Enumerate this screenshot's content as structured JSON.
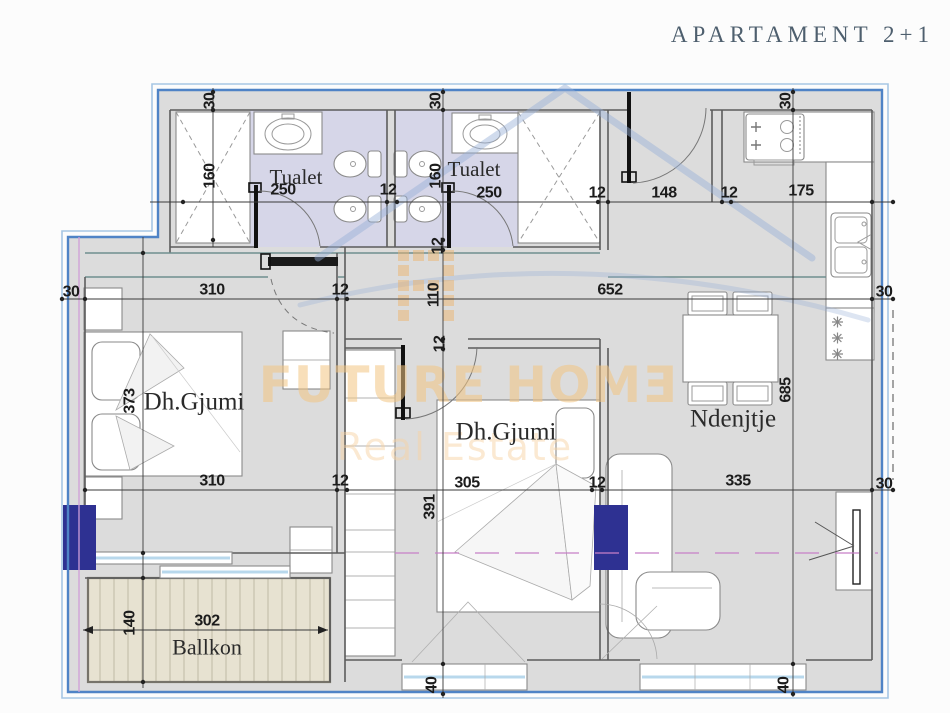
{
  "title": "APARTAMENT  2+1",
  "watermark": {
    "line1": "FUTURE HOMƎ",
    "line2": "Real Estate"
  },
  "room_labels": [
    {
      "text": "Tualet",
      "x": 296,
      "y": 177,
      "size": 21
    },
    {
      "text": "Tualet",
      "x": 474,
      "y": 169,
      "size": 21
    },
    {
      "text": "Dh.Gjumi",
      "x": 194,
      "y": 402,
      "size": 25
    },
    {
      "text": "Dh.Gjumi",
      "x": 506,
      "y": 432,
      "size": 25
    },
    {
      "text": "Ndenjtje",
      "x": 733,
      "y": 419,
      "size": 25
    },
    {
      "text": "Ballkon",
      "x": 207,
      "y": 647,
      "size": 22
    }
  ],
  "dimension_labels": [
    {
      "text": "30",
      "x": 210,
      "y": 101,
      "rot": true
    },
    {
      "text": "160",
      "x": 210,
      "y": 176,
      "rot": true
    },
    {
      "text": "250",
      "x": 283,
      "y": 190
    },
    {
      "text": "12",
      "x": 388,
      "y": 190
    },
    {
      "text": "30",
      "x": 436,
      "y": 101,
      "rot": true
    },
    {
      "text": "160",
      "x": 436,
      "y": 176,
      "rot": true
    },
    {
      "text": "250",
      "x": 489,
      "y": 193
    },
    {
      "text": "12",
      "x": 597,
      "y": 193
    },
    {
      "text": "148",
      "x": 664,
      "y": 193
    },
    {
      "text": "12",
      "x": 729,
      "y": 193
    },
    {
      "text": "175",
      "x": 801,
      "y": 191
    },
    {
      "text": "30",
      "x": 786,
      "y": 101,
      "rot": true
    },
    {
      "text": "12",
      "x": 438,
      "y": 246,
      "rot": true
    },
    {
      "text": "30",
      "x": 71,
      "y": 292
    },
    {
      "text": "310",
      "x": 212,
      "y": 290
    },
    {
      "text": "12",
      "x": 340,
      "y": 290
    },
    {
      "text": "110",
      "x": 434,
      "y": 295,
      "rot": true
    },
    {
      "text": "652",
      "x": 610,
      "y": 290
    },
    {
      "text": "30",
      "x": 884,
      "y": 292
    },
    {
      "text": "12",
      "x": 440,
      "y": 344,
      "rot": true
    },
    {
      "text": "373",
      "x": 130,
      "y": 401,
      "rot": true
    },
    {
      "text": "391",
      "x": 430,
      "y": 507,
      "rot": true
    },
    {
      "text": "685",
      "x": 786,
      "y": 390,
      "rot": true
    },
    {
      "text": "310",
      "x": 212,
      "y": 481
    },
    {
      "text": "12",
      "x": 340,
      "y": 481
    },
    {
      "text": "305",
      "x": 467,
      "y": 483
    },
    {
      "text": "12",
      "x": 597,
      "y": 483
    },
    {
      "text": "335",
      "x": 738,
      "y": 481
    },
    {
      "text": "30",
      "x": 884,
      "y": 484
    },
    {
      "text": "140",
      "x": 130,
      "y": 623,
      "rot": true
    },
    {
      "text": "302",
      "x": 207,
      "y": 621
    },
    {
      "text": "40",
      "x": 432,
      "y": 685,
      "rot": true
    },
    {
      "text": "40",
      "x": 784,
      "y": 685,
      "rot": true
    }
  ],
  "colors": {
    "boundary_blue": "#4f83c6",
    "boundary_blue_light": "#a6c6e4",
    "floor_gray": "#dcdcdc",
    "bathroom_lavender": "#d6d6e8",
    "balcony_beige": "#e7e2d1",
    "column_navy": "#2e3192",
    "watermark_orange": "#f3c482",
    "watermark_blue": "#96afd7",
    "axis_magenta": "#c77fc7",
    "title_color": "#4e5f6e"
  }
}
